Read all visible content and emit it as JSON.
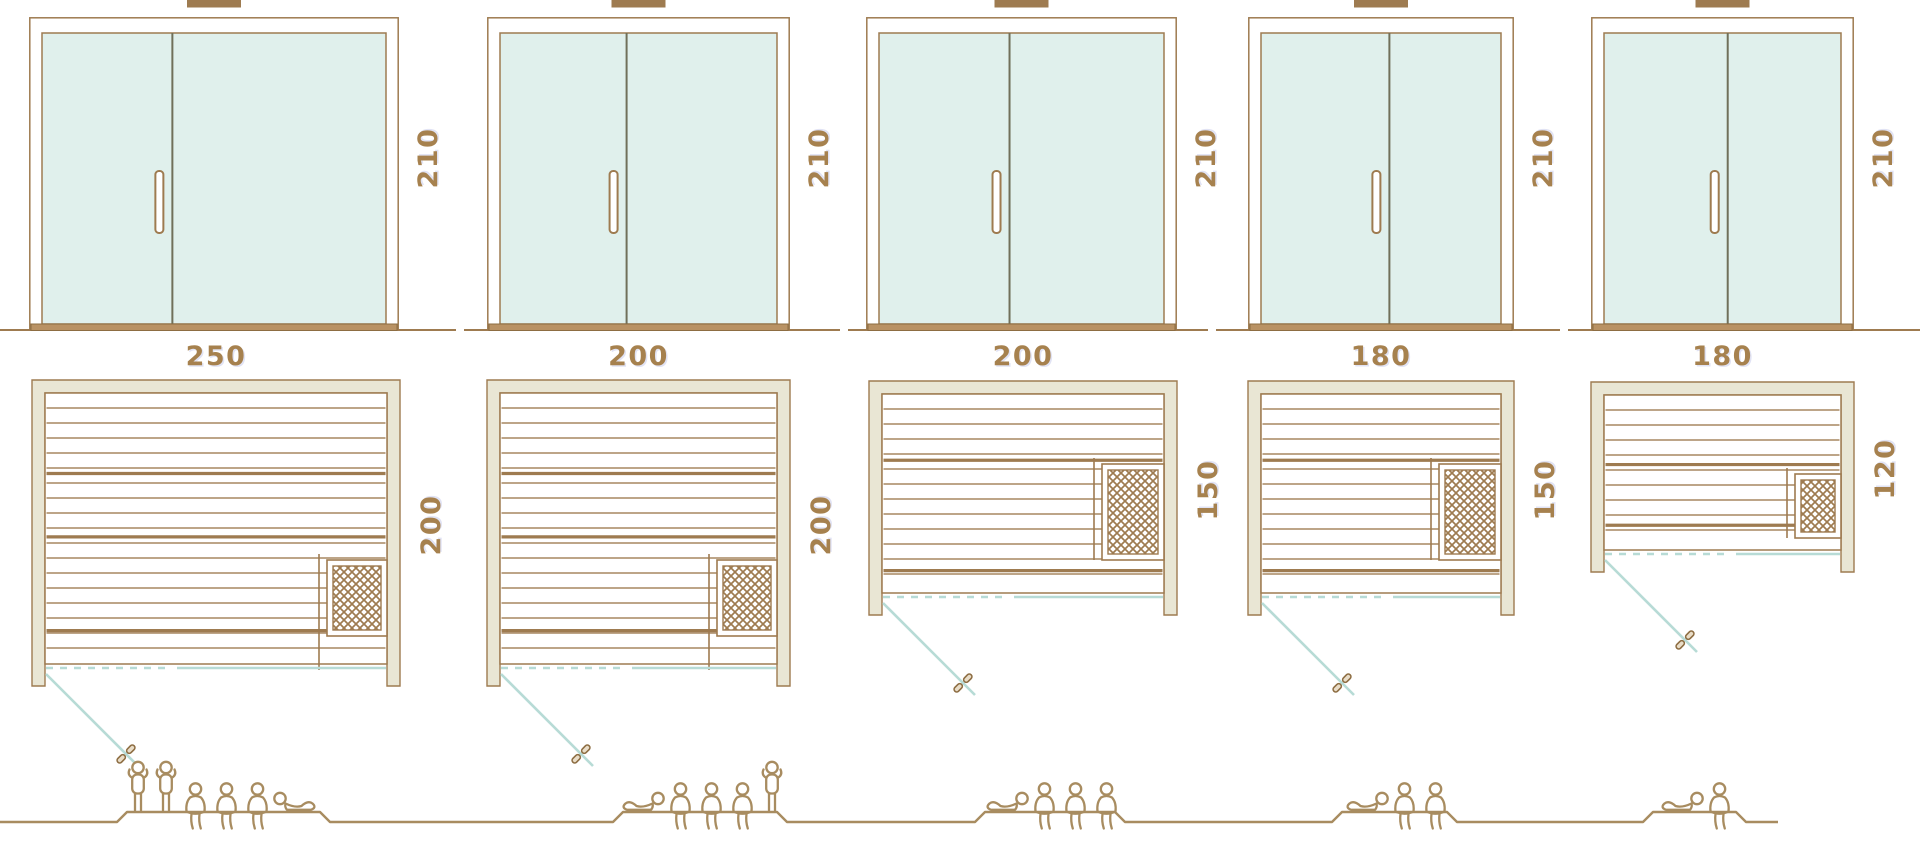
{
  "colors": {
    "line_brown": "#9e7b50",
    "dimension_text": "#a6814e",
    "wall_beige": "#e9e6d4",
    "glass_mint": "#e0f0ec",
    "teal_glass_line": "#b7dbd6",
    "door_divider_dark": "#70705a",
    "figure_tan": "#a88c60",
    "sill_brown": "#b99264"
  },
  "saunas": [
    {
      "door_height": "210",
      "width": "250",
      "depth": "200",
      "capacity": 6,
      "people": [
        "standing",
        "standing",
        "sitting",
        "sitting",
        "sitting",
        "reclining"
      ]
    },
    {
      "door_height": "210",
      "width": "200",
      "depth": "200",
      "capacity": 5,
      "people": [
        "reclining",
        "sitting",
        "sitting",
        "sitting",
        "standing"
      ]
    },
    {
      "door_height": "210",
      "width": "200",
      "depth": "150",
      "capacity": 4,
      "people": [
        "reclining",
        "sitting",
        "sitting",
        "sitting"
      ]
    },
    {
      "door_height": "210",
      "width": "180",
      "depth": "150",
      "capacity": 3,
      "people": [
        "reclining",
        "sitting",
        "sitting"
      ]
    },
    {
      "door_height": "210",
      "width": "180",
      "depth": "120",
      "capacity": 2,
      "people": [
        "reclining",
        "sitting"
      ]
    }
  ]
}
